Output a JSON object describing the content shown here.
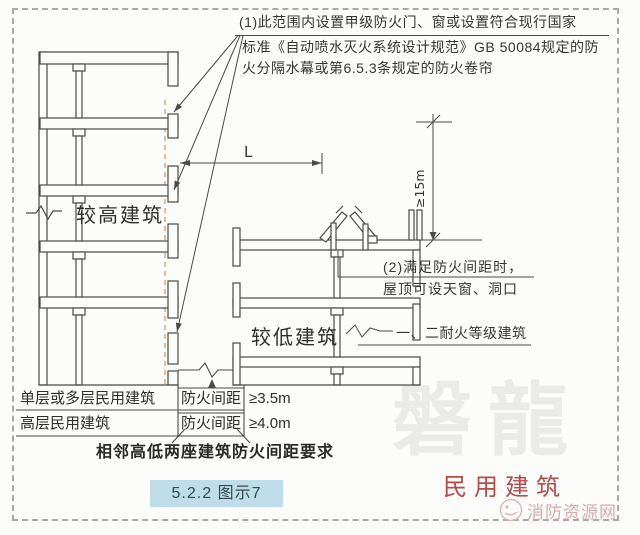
{
  "annotations": {
    "note1": {
      "line1": "(1)此范围内设置甲级防火门、窗或设置符合现行国家",
      "line2": "标准《自动喷水灭火系统设计规范》GB 50084规定的防",
      "line3": "火分隔水幕或第6.5.3条规定的防火卷帘"
    },
    "note2": {
      "line1": "(2)满足防火间距时，",
      "line2": "屋顶可设天窗、洞口"
    },
    "fire_resistance_label": "一、二耐火等级建筑"
  },
  "drawing": {
    "high_building_label": "较高建筑",
    "low_building_label": "较低建筑",
    "distance_dim_label": "L",
    "height_dim_label": "≥15m"
  },
  "table": {
    "rows": [
      {
        "building_type": "单层或多层民用建筑",
        "dim_label": "防火间距",
        "value": "≥3.5m"
      },
      {
        "building_type": "高层民用建筑",
        "dim_label": "防火间距",
        "value": "≥4.0m"
      }
    ],
    "caption": "相邻高低两座建筑防火间距要求"
  },
  "footer": {
    "figure_ref": "5.2.2 图示7",
    "category_label": "民用建筑"
  },
  "watermarks": {
    "center_text": "磐龍",
    "site_text": "消防资源网"
  },
  "colors": {
    "line": "#4a4a4a",
    "protected_zone_orange": "#e8b488",
    "figure_ref_bg": "#bfdce9",
    "category_red": "#b84a4a",
    "watermark_gray": "#eaeae7",
    "watermark_pink": "#d9abab"
  }
}
